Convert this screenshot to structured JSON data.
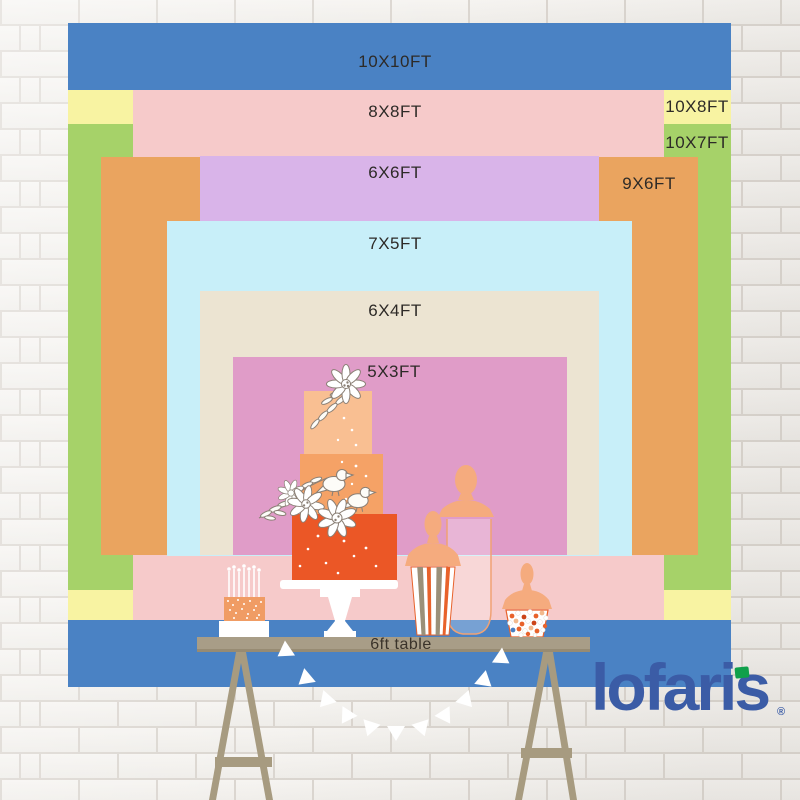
{
  "backdrops": [
    {
      "id": "10x10",
      "label": "10X10FT",
      "color": "#4a82c4"
    },
    {
      "id": "10x8",
      "label": "10X8FT",
      "color": "#f8f3a2"
    },
    {
      "id": "10x7",
      "label": "10X7FT",
      "color": "#a6d269"
    },
    {
      "id": "8x8",
      "label": "8X8FT",
      "color": "#f6caca"
    },
    {
      "id": "9x6",
      "label": "9X6FT",
      "color": "#eaa45f"
    },
    {
      "id": "6x6",
      "label": "6X6FT",
      "color": "#d9b4e9"
    },
    {
      "id": "7x5",
      "label": "7X5FT",
      "color": "#c8eff9"
    },
    {
      "id": "6x4",
      "label": "6X4FT",
      "color": "#ece4d2"
    },
    {
      "id": "5x3",
      "label": "5X3FT",
      "color": "#e09cc8"
    }
  ],
  "table": {
    "label": "6ft table"
  },
  "brand": {
    "name": "lofaris",
    "mark": "®",
    "color": "#3b5ca6",
    "flag_color": "#10a04b"
  },
  "illustration": {
    "items": [
      "tiered-cake",
      "small-candle-cake",
      "apothecary-jars",
      "popcorn-box",
      "candy-cup",
      "bunting-garland",
      "trestle-table"
    ]
  }
}
